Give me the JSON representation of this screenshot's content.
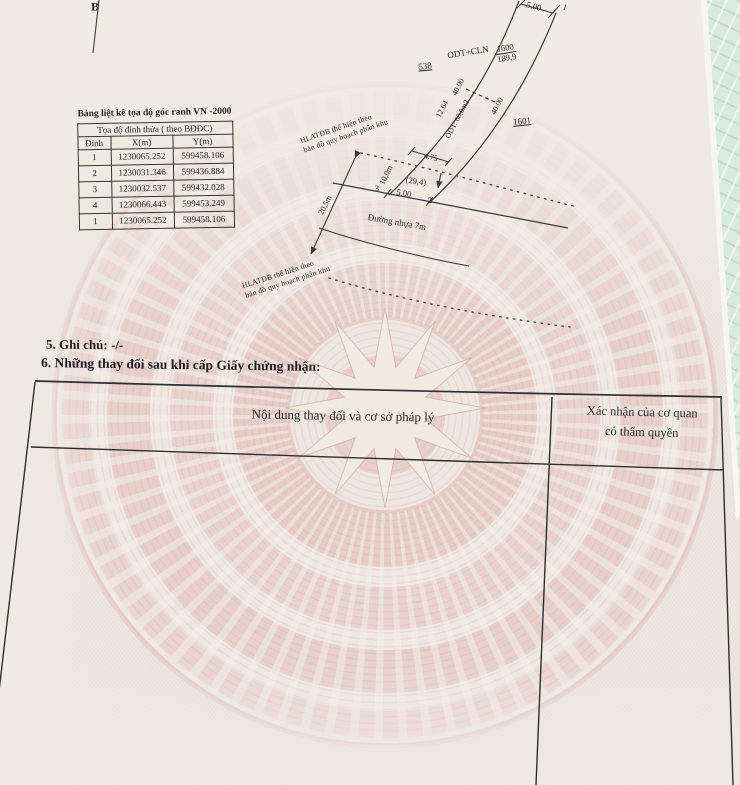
{
  "colors": {
    "paper": "#ede8e1",
    "pattern_pink": "#e6cac5",
    "cloth_teal": "#d9eae2",
    "ink": "#26262c"
  },
  "b_marker": "B",
  "coordinate_table": {
    "title": "Bảng liệt kê tọa độ góc ranh VN -2000",
    "header": "Tọa độ đỉnh thửa ( theo BĐĐC)",
    "columns": [
      "Đỉnh",
      "X(m)",
      "Y(m)"
    ],
    "rows": [
      [
        "1",
        "1230065.252",
        "599458.106"
      ],
      [
        "2",
        "1230031.346",
        "599436.884"
      ],
      [
        "3",
        "1230032.537",
        "599432.028"
      ],
      [
        "4",
        "1230066.443",
        "599453.249"
      ],
      [
        "1",
        "1230065.252",
        "599458.106"
      ]
    ]
  },
  "diagram": {
    "labels": {
      "top_width": "5.00",
      "point_1": "1",
      "point_2": "2",
      "point_3": "3",
      "neighbor_left": "538",
      "neighbor_right": "1601",
      "land_use": "ODT+CLN",
      "parcel_number": "1600",
      "parcel_area": "189,9",
      "side_left": "40.00",
      "side_left_2": "12.64",
      "odt_area": "ODT: 60,0m2",
      "side_right": "40.00",
      "dim_4_75": "4.75",
      "depth_10m": "10,0m",
      "area_29_4": "(29,4)",
      "front_width": "5.00",
      "corridor_20_5m": "20,5m",
      "road_label": "Đường nhựa 7m",
      "hl_note_line1": "HLATĐB thể hiện theo",
      "hl_note_line2": "bản đồ quy hoạch phân khu"
    }
  },
  "notes": {
    "ghi_chu": "5. Ghi chú: -/-",
    "changes_heading": "6. Những thay đổi sau khi cấp Giấy chứng nhận:"
  },
  "changes_table": {
    "col1": "Nội dung thay đổi và cơ sở pháp lý",
    "col2_line1": "Xác nhận của cơ quan",
    "col2_line2": "có thẩm quyền"
  }
}
